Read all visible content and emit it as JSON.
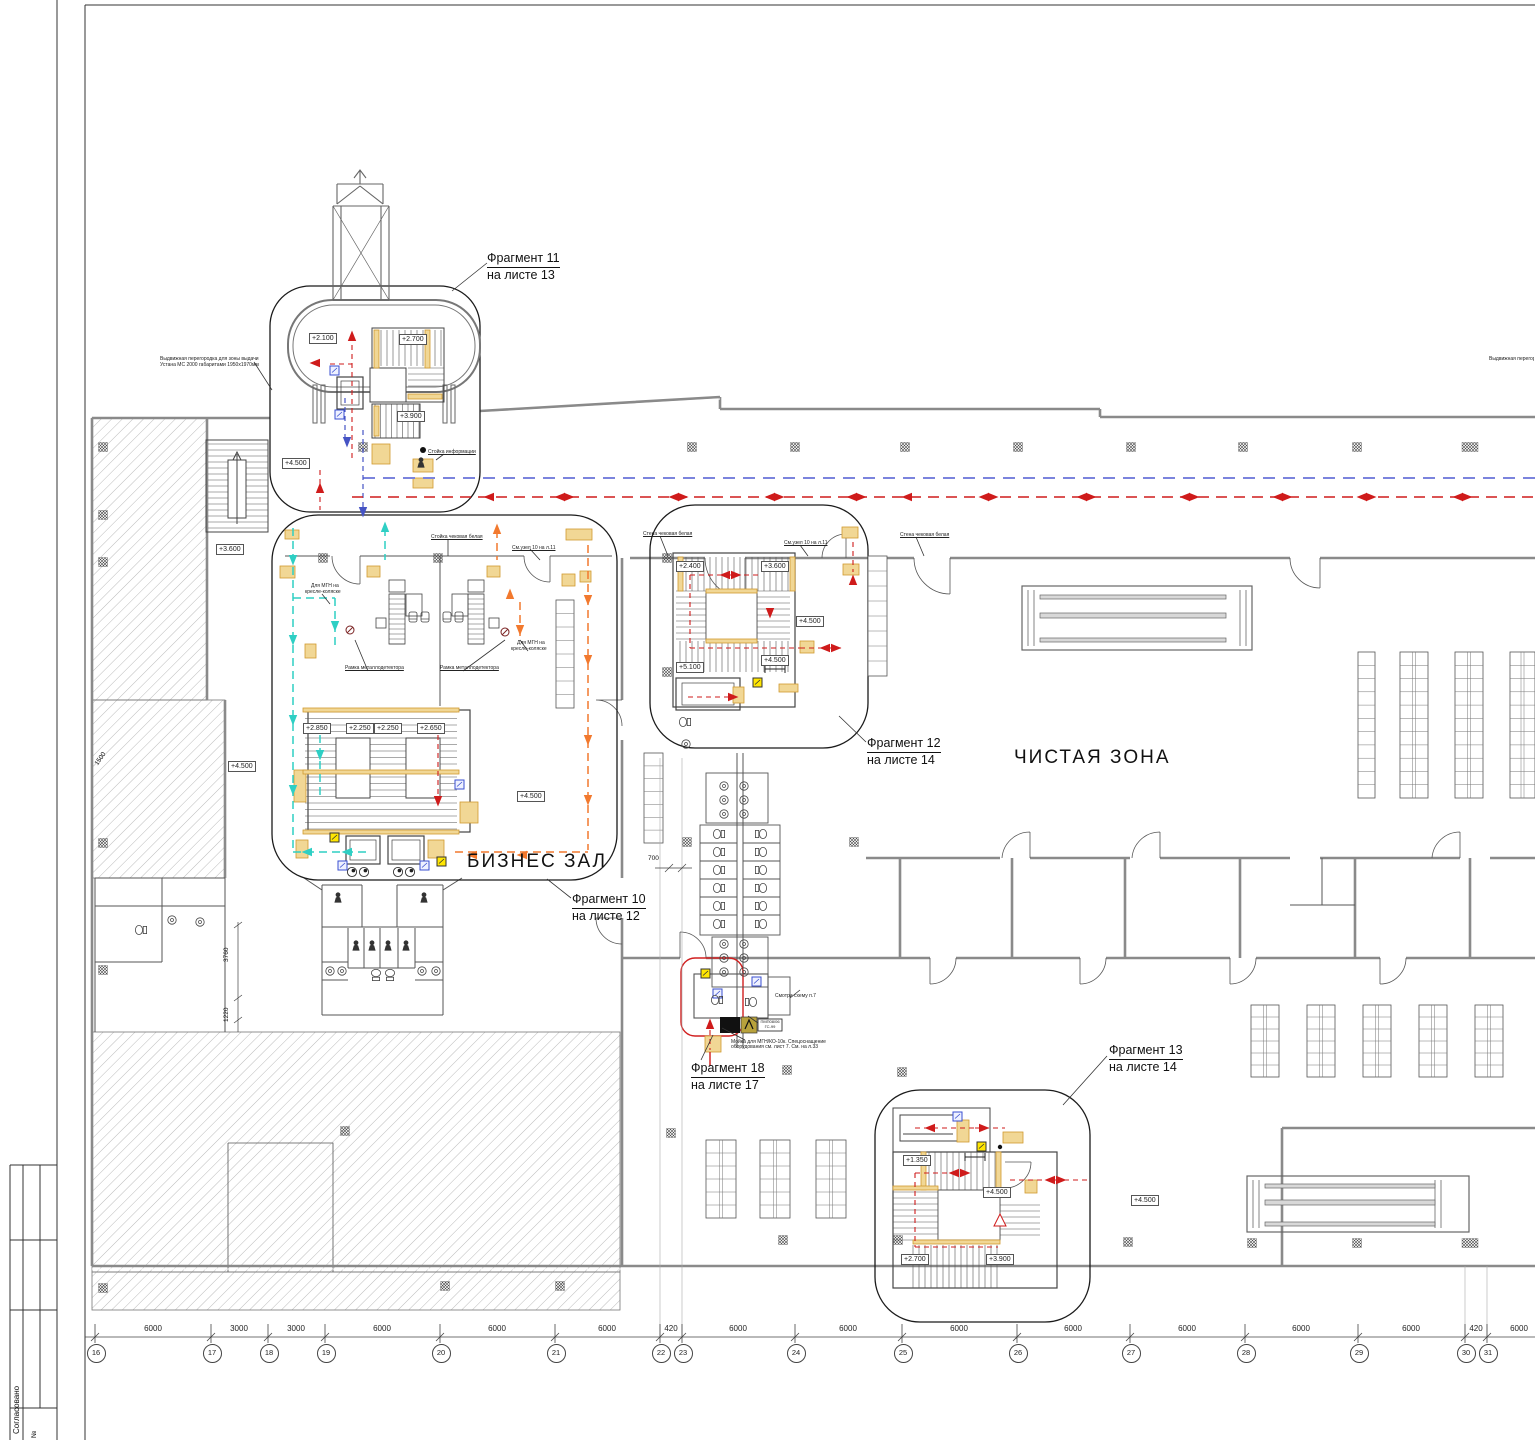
{
  "sheet": {
    "approved_stamp": "Согласовано",
    "row_number_label": "№"
  },
  "zones": {
    "business_hall": "БИЗНЕС ЗАЛ",
    "clean_zone": "ЧИСТАЯ ЗОНА"
  },
  "fragments": [
    {
      "title": "Фрагмент 11",
      "sheet_ref": "на листе 13"
    },
    {
      "title": "Фрагмент 10",
      "sheet_ref": "на листе 12"
    },
    {
      "title": "Фрагмент 12",
      "sheet_ref": "на листе 14"
    },
    {
      "title": "Фрагмент 13",
      "sheet_ref": "на листе 14"
    },
    {
      "title": "Фрагмент 18",
      "sheet_ref": "на листе 17"
    }
  ],
  "elevations": [
    "+2.100",
    "+2.700",
    "+3.900",
    "+4.500",
    "+3.600",
    "+4.500",
    "+2.850",
    "+2.250",
    "+2.250",
    "+2.650",
    "+4.500",
    "+2.400",
    "+3.600",
    "+4.500",
    "+4.500",
    "+5.100",
    "+1.350",
    "+4.500",
    "+2.700",
    "+3.900",
    "+4.500"
  ],
  "grid": {
    "bubbles": [
      "16",
      "17",
      "18",
      "19",
      "20",
      "21",
      "22",
      "23",
      "24",
      "25",
      "26",
      "27",
      "28",
      "29",
      "30",
      "31"
    ],
    "spans": [
      "6000",
      "3000",
      "3000",
      "6000",
      "6000",
      "6000",
      "420",
      "6000",
      "6000",
      "6000",
      "6000",
      "6000",
      "6000",
      "6000",
      "420",
      "6000"
    ]
  },
  "dimensions": {
    "left_diag": "1500",
    "left_v1": "3760",
    "left_v2": "1220",
    "corridor": "700"
  },
  "annotations": {
    "partition_note": [
      "Выдвижная перегородка для зоны выдачи",
      "Устана МС 2000 габаритами 1950х1970мм"
    ],
    "counter_white": "Стойка чековая белая",
    "wall_white": "Стена чековая белая",
    "node_ref": "См.узел 10 на л.11",
    "mgn_note": [
      "Для МГН на",
      "кресле-коляске"
    ],
    "detector_frame": "Рамка металлодетектора",
    "info_desk": "Стойка информации",
    "see_scheme": "Смотри схему п.7",
    "wash_note": [
      "Мойка для МГН/КО-10к. Спецоснащение",
      "оборудования см. лист 7. См. на л.33"
    ],
    "equip_tag": [
      "ПМП08/06",
      "ГС-99"
    ]
  }
}
